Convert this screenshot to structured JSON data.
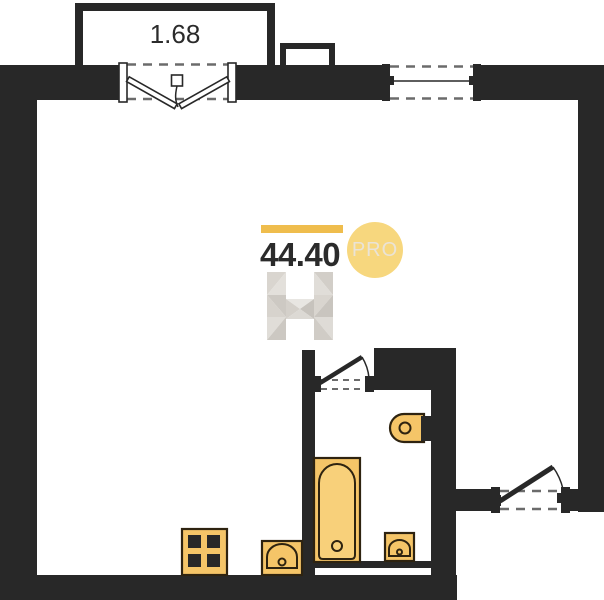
{
  "labels": {
    "balcony_area": "1.68",
    "total_area": "44.40",
    "badge": "PRO"
  },
  "colors": {
    "wall": "#282828",
    "fixture_fill": "#f5c568",
    "fixture_fill_light": "#f8d07a",
    "fixture_outline": "#2e2310",
    "brand_bar": "#efbd4d",
    "badge_circle": "#f7d77e",
    "badge_text": "#eae3d6",
    "dash": "#6b6b6b",
    "label_text": "#2b2b2b",
    "background": "#ffffff"
  },
  "plan_elements": {
    "rooms": [
      "main-room",
      "bathroom",
      "balcony"
    ],
    "openings": [
      "balcony-french-door",
      "window",
      "entrance-door",
      "bathroom-door"
    ],
    "fixtures": [
      "stove",
      "kitchen-sink",
      "bathtub",
      "bathroom-sink",
      "toilet"
    ]
  }
}
